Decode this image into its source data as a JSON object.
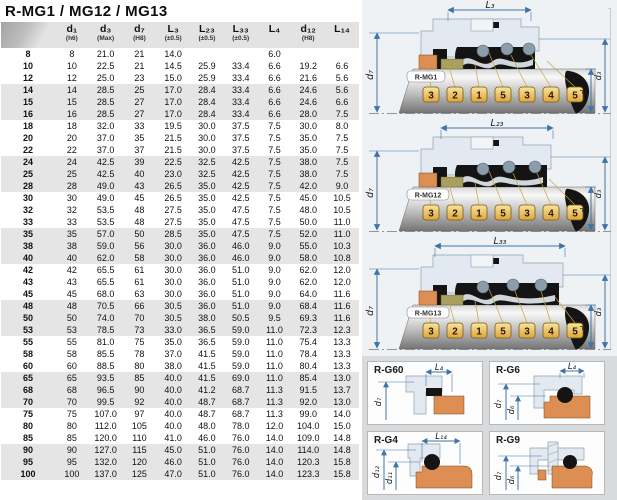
{
  "page": {
    "title": "R-MG1 / MG12 / MG13"
  },
  "colors": {
    "dimension_line": "#3f74a8",
    "callout_fill": "#f2c95c",
    "callout_border": "#7a5c10",
    "orange_part": "#dd8e52",
    "olive_part": "#a9a05f",
    "black_part": "#141414",
    "spring_gray": "#8b9dab",
    "gland_fill": "#e2e9f0",
    "header_bg": "#e3e3e3",
    "row_band": "#e5e5e5",
    "panel_area_bg": "#d9dadb",
    "diagram_bg": "#eff2f5"
  },
  "table": {
    "columns": [
      {
        "label": "",
        "note": ""
      },
      {
        "label": "d₁",
        "note": "(h6)"
      },
      {
        "label": "d₃",
        "note": "(Max)"
      },
      {
        "label": "d₇",
        "note": "(H8)"
      },
      {
        "label": "L₃",
        "note": "(±0.5)"
      },
      {
        "label": "L₂₃",
        "note": "(±0.5)"
      },
      {
        "label": "L₃₃",
        "note": "(±0.5)"
      },
      {
        "label": "L₄",
        "note": ""
      },
      {
        "label": "d₁₂",
        "note": "(H8)"
      },
      {
        "label": "L₁₄",
        "note": ""
      }
    ],
    "rows": [
      [
        "8",
        "8",
        "21.0",
        "21",
        "14.0",
        "",
        "",
        "6.0",
        "",
        ""
      ],
      [
        "10",
        "10",
        "22.5",
        "21",
        "14.5",
        "25.9",
        "33.4",
        "6.6",
        "19.2",
        "6.6"
      ],
      [
        "12",
        "12",
        "25.0",
        "23",
        "15.0",
        "25.9",
        "33.4",
        "6.6",
        "21.6",
        "5.6"
      ],
      [
        "14",
        "14",
        "28.5",
        "25",
        "17.0",
        "28.4",
        "33.4",
        "6.6",
        "24.6",
        "5.6"
      ],
      [
        "15",
        "15",
        "28.5",
        "27",
        "17.0",
        "28.4",
        "33.4",
        "6.6",
        "24.6",
        "6.6"
      ],
      [
        "16",
        "16",
        "28.5",
        "27",
        "17.0",
        "28.4",
        "33.4",
        "6.6",
        "28.0",
        "7.5"
      ],
      [
        "18",
        "18",
        "32.0",
        "33",
        "19.5",
        "30.0",
        "37.5",
        "7.5",
        "30.0",
        "8.0"
      ],
      [
        "20",
        "20",
        "37.0",
        "35",
        "21.5",
        "30.0",
        "37.5",
        "7.5",
        "35.0",
        "7.5"
      ],
      [
        "22",
        "22",
        "37.0",
        "37",
        "21.5",
        "30.0",
        "37.5",
        "7.5",
        "35.0",
        "7.5"
      ],
      [
        "24",
        "24",
        "42.5",
        "39",
        "22.5",
        "32.5",
        "42.5",
        "7.5",
        "38.0",
        "7.5"
      ],
      [
        "25",
        "25",
        "42.5",
        "40",
        "23.0",
        "32.5",
        "42.5",
        "7.5",
        "38.0",
        "7.5"
      ],
      [
        "28",
        "28",
        "49.0",
        "43",
        "26.5",
        "35.0",
        "42.5",
        "7.5",
        "42.0",
        "9.0"
      ],
      [
        "30",
        "30",
        "49.0",
        "45",
        "26.5",
        "35.0",
        "42.5",
        "7.5",
        "45.0",
        "10.5"
      ],
      [
        "32",
        "32",
        "53.5",
        "48",
        "27.5",
        "35.0",
        "47.5",
        "7.5",
        "48.0",
        "10.5"
      ],
      [
        "33",
        "33",
        "53.5",
        "48",
        "27.5",
        "35.0",
        "47.5",
        "7.5",
        "50.0",
        "11.0"
      ],
      [
        "35",
        "35",
        "57.0",
        "50",
        "28.5",
        "35.0",
        "47.5",
        "7.5",
        "52.0",
        "11.0"
      ],
      [
        "38",
        "38",
        "59.0",
        "56",
        "30.0",
        "36.0",
        "46.0",
        "9.0",
        "55.0",
        "10.3"
      ],
      [
        "40",
        "40",
        "62.0",
        "58",
        "30.0",
        "36.0",
        "46.0",
        "9.0",
        "58.0",
        "10.8"
      ],
      [
        "42",
        "42",
        "65.5",
        "61",
        "30.0",
        "36.0",
        "51.0",
        "9.0",
        "62.0",
        "12.0"
      ],
      [
        "43",
        "43",
        "65.5",
        "61",
        "30.0",
        "36.0",
        "51.0",
        "9.0",
        "62.0",
        "12.0"
      ],
      [
        "45",
        "45",
        "68.0",
        "63",
        "30.0",
        "36.0",
        "51.0",
        "9.0",
        "64.0",
        "11.6"
      ],
      [
        "48",
        "48",
        "70.5",
        "66",
        "30.5",
        "36.0",
        "51.0",
        "9.0",
        "68.4",
        "11.6"
      ],
      [
        "50",
        "50",
        "74.0",
        "70",
        "30.5",
        "38.0",
        "50.5",
        "9.5",
        "69.3",
        "11.6"
      ],
      [
        "53",
        "53",
        "78.5",
        "73",
        "33.0",
        "36.5",
        "59.0",
        "11.0",
        "72.3",
        "12.3"
      ],
      [
        "55",
        "55",
        "81.0",
        "75",
        "35.0",
        "36.5",
        "59.0",
        "11.0",
        "75.4",
        "13.3"
      ],
      [
        "58",
        "58",
        "85.5",
        "78",
        "37.0",
        "41.5",
        "59.0",
        "11.0",
        "78.4",
        "13.3"
      ],
      [
        "60",
        "60",
        "88.5",
        "80",
        "38.0",
        "41.5",
        "59.0",
        "11.0",
        "80.4",
        "13.3"
      ],
      [
        "65",
        "65",
        "93.5",
        "85",
        "40.0",
        "41.5",
        "69.0",
        "11.0",
        "85.4",
        "13.0"
      ],
      [
        "68",
        "68",
        "96.5",
        "90",
        "40.0",
        "41.2",
        "68.7",
        "11.3",
        "91.5",
        "13.7"
      ],
      [
        "70",
        "70",
        "99.5",
        "92",
        "40.0",
        "48.7",
        "68.7",
        "11.3",
        "92.0",
        "13.0"
      ],
      [
        "75",
        "75",
        "107.0",
        "97",
        "40.0",
        "48.7",
        "68.7",
        "11.3",
        "99.0",
        "14.0"
      ],
      [
        "80",
        "80",
        "112.0",
        "105",
        "40.0",
        "48.0",
        "78.0",
        "12.0",
        "104.0",
        "15.0"
      ],
      [
        "85",
        "85",
        "120.0",
        "110",
        "41.0",
        "46.0",
        "76.0",
        "14.0",
        "109.0",
        "14.8"
      ],
      [
        "90",
        "90",
        "127.0",
        "115",
        "45.0",
        "51.0",
        "76.0",
        "14.0",
        "114.0",
        "14.8"
      ],
      [
        "95",
        "95",
        "132.0",
        "120",
        "46.0",
        "51.0",
        "76.0",
        "14.0",
        "120.3",
        "15.8"
      ],
      [
        "100",
        "100",
        "137.0",
        "125",
        "47.0",
        "51.0",
        "76.0",
        "14.0",
        "123.3",
        "15.8"
      ]
    ]
  },
  "diagrams": [
    {
      "label": "R-MG1",
      "dim_top": "L₃",
      "dim_left": "d₇",
      "dim_inner": "d₁",
      "dim_outer": "d₃",
      "callouts": [
        "3",
        "2",
        "1",
        "5",
        "3",
        "4",
        "5"
      ]
    },
    {
      "label": "R-MG12",
      "dim_top": "L₂₃",
      "dim_left": "d₇",
      "dim_inner": "d₁",
      "dim_outer": "d₃",
      "callouts": [
        "3",
        "2",
        "1",
        "5",
        "3",
        "4",
        "5"
      ]
    },
    {
      "label": "R-MG13",
      "dim_top": "L₃₃",
      "dim_left": "d₇",
      "dim_inner": "d₁",
      "dim_outer": "d₃",
      "callouts": [
        "3",
        "2",
        "1",
        "5",
        "3",
        "4",
        "5"
      ]
    }
  ],
  "detail_panels": [
    {
      "label": "R-G60",
      "dim_top": "L₄",
      "dims_left": [
        "d₇"
      ]
    },
    {
      "label": "R-G6",
      "dim_top": "L₄",
      "dims_left": [
        "d₇",
        "d₆"
      ]
    },
    {
      "label": "R-G4",
      "dim_top": "L₁₄",
      "dims_left": [
        "d₁₂",
        "d₁₁"
      ]
    },
    {
      "label": "R-G9",
      "dim_top": "",
      "dims_left": [
        "d₇",
        "d₆"
      ]
    }
  ]
}
